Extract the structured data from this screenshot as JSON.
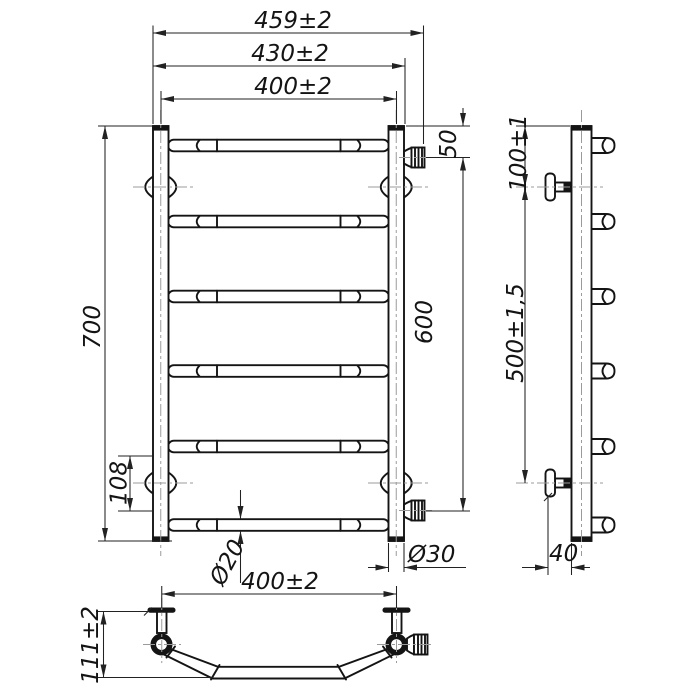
{
  "drawing": {
    "title": "Ladder towel rail — dimensional drawing",
    "colors": {
      "object_line": "#141414",
      "dimension_line": "#222222",
      "centerline": "#9b9b9b",
      "background": "#ffffff"
    },
    "front": {
      "rung_count": 6,
      "dim_width_overall": "459±2",
      "dim_width_outer": "430±2",
      "dim_width_centers": "400±2",
      "dim_height": "700",
      "dim_rung_gap": "108",
      "dim_top_offset": "50",
      "dim_connection_span": "600",
      "dim_rung_dia": "Ø20",
      "dim_post_dia": "Ø30"
    },
    "side": {
      "stub_count": 6,
      "bracket_count": 2,
      "dim_bracket_top": "100±1",
      "dim_bracket_span": "500±1,5",
      "dim_wall_offset": "40"
    },
    "bottom": {
      "dim_width_centers": "400±2",
      "dim_depth": "111±2"
    }
  }
}
